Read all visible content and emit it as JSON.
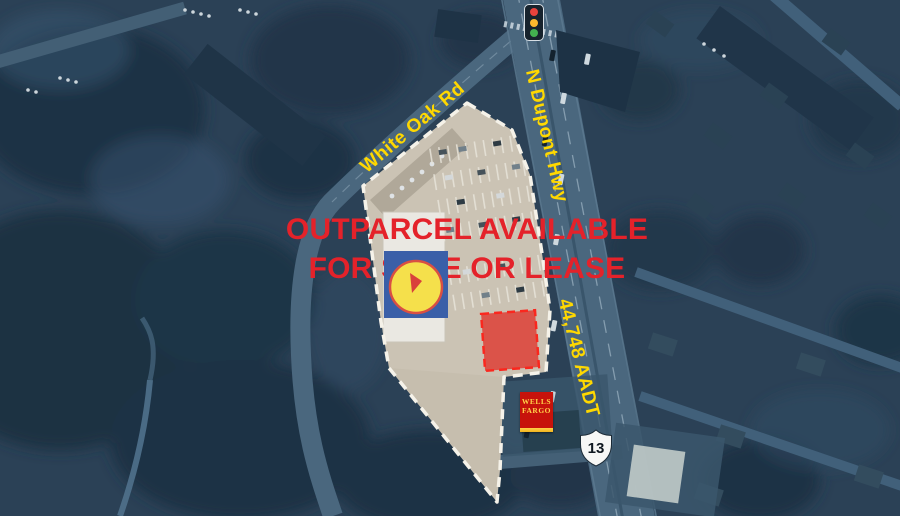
{
  "headline": {
    "line1": "OUTPARCEL AVAILABLE",
    "line2": "FOR SALE OR LEASE"
  },
  "labels": {
    "white_oak_rd": "White Oak Rd",
    "n_dupont_hwy": "N Dupont Hwy",
    "traffic_count": "44,748 AADT"
  },
  "route_shield": {
    "number": "13"
  },
  "wells_fargo": {
    "line1": "WELLS",
    "line2": "FARGO"
  },
  "icons": {
    "traffic_light": "traffic-light-icon",
    "route_shield": "us-route-13-shield",
    "wells_fargo": "wells-fargo-sign",
    "lidl": "lidl-logo"
  },
  "colors": {
    "headline_red": "#e4222a",
    "label_yellow": "#ffd800",
    "overlay_blue": "#2b4156",
    "parcel_fill": "#cbc3b4",
    "parcel_border": "#f5f2e9",
    "outparcel_fill": "#dd4a41",
    "outparcel_border": "#ff1a12",
    "wells_fargo_red": "#c7130b",
    "wells_fargo_gold": "#ffd24a",
    "lidl_blue": "#3a5fa8",
    "lidl_yellow": "#f5e04b",
    "lidl_red": "#d9413b"
  }
}
